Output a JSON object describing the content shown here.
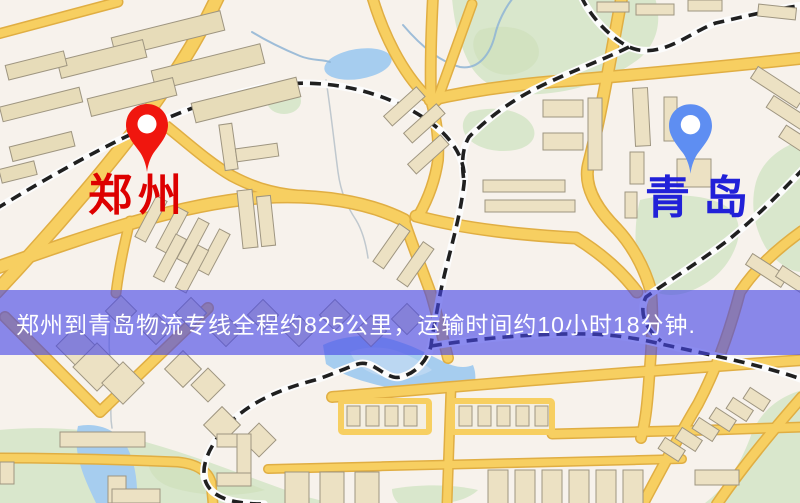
{
  "banner": {
    "text": "郑州到青岛物流专线全程约825公里，运输时间约10小时18分钟."
  },
  "origin": {
    "label": "郑州"
  },
  "destination": {
    "label": "青岛"
  },
  "icons": {
    "origin_pin": "map-pin-icon",
    "destination_pin": "map-pin-icon"
  },
  "colors": {
    "background": "#f7f2ec",
    "road": "#f6cf63",
    "road_edge": "#dfae45",
    "railway": "#202020",
    "water": "#a7cdee",
    "park": "#d9e7cc",
    "building": "#ece1c4",
    "banner_bg": "rgba(70,70,230,0.62)",
    "banner_text": "#ffffff",
    "origin_label": "#dd0000",
    "origin_pin": "#f0160e",
    "dest_label": "#2121d8",
    "dest_pin": "#5e8ef2"
  }
}
